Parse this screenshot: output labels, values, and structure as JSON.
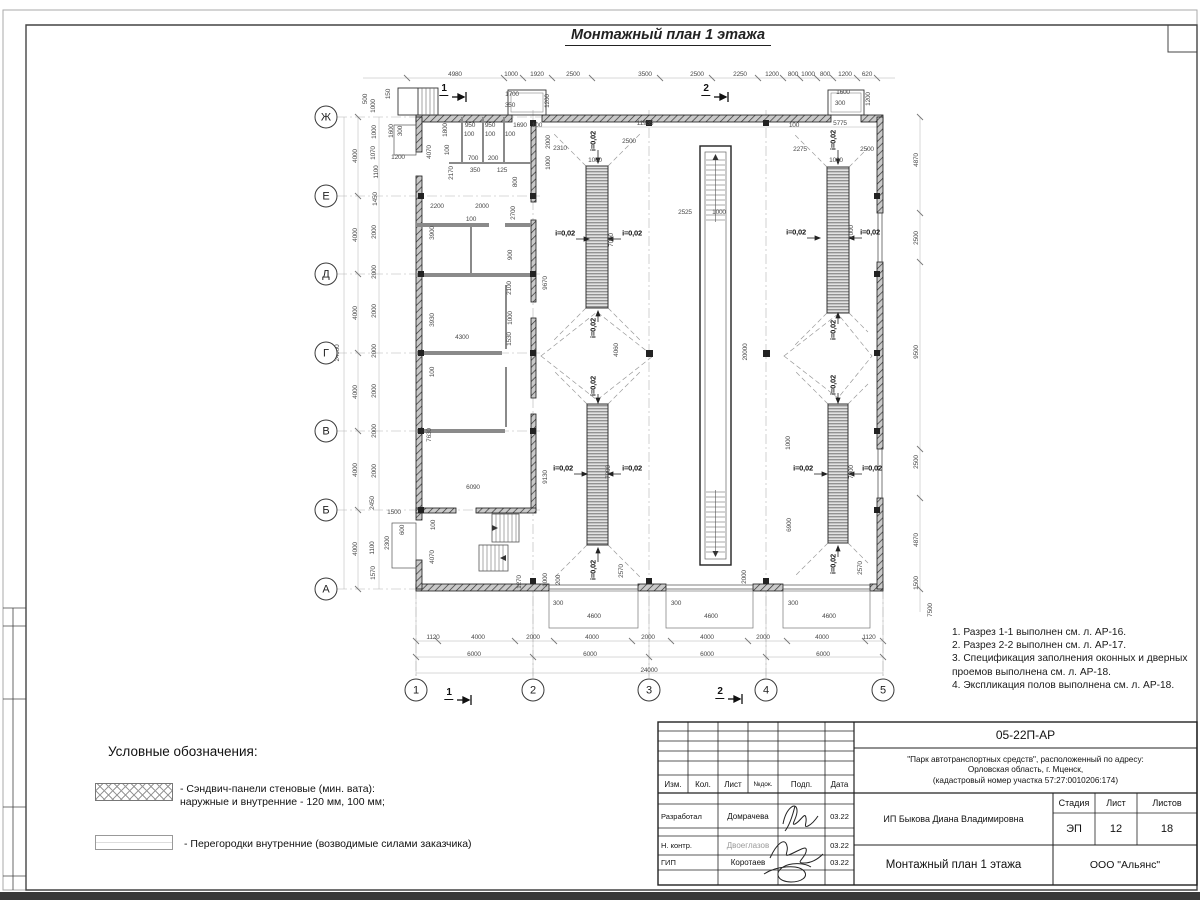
{
  "sheet": {
    "title": "Монтажный план 1 этажа"
  },
  "notes": {
    "items": [
      "1. Разрез 1-1 выполнен см. л. АР-16.",
      "2. Разрез 2-2 выполнен см. л. АР-17.",
      "3. Спецификация заполнения оконных и дверных\n    проемов выполнена см. л. АР-18.",
      "4. Экспликация полов выполнена см. л. АР-18."
    ]
  },
  "legend": {
    "title": "Условные обозначения:",
    "item1": "- Сэндвич-панели стеновые (мин. вата):\nнаружные и внутренние - 120 мм, 100 мм;",
    "item2": "- Перегородки внутренние (возводимые силами заказчика)"
  },
  "title_block": {
    "doc_number": "05-22П-АР",
    "project": "\"Парк автотранспортных средств\",  расположенный по адресу:\nОрловская область, г. Мценск,\n(кадастровый номер участка 57:27:0010206:174)",
    "client": "ИП Быкова Диана Владимировна",
    "sheet_title": "Монтажный план 1 этажа",
    "organization": "ООО \"Альянс\"",
    "stage_label": "Стадия",
    "stage": "ЭП",
    "sheet_label": "Лист",
    "sheet_no": "12",
    "sheets_label": "Листов",
    "sheets_total": "18",
    "col_izm": "Изм.",
    "col_kol": "Кол.",
    "col_list": "Лист",
    "col_ndok": "№док.",
    "col_podp": "Подп.",
    "col_data": "Дата",
    "rows": [
      {
        "role": "Разработал",
        "name": "Домрачева",
        "date": "03.22"
      },
      {
        "role": "Н. контр.",
        "name": "Двоеглазов",
        "date": "03.22"
      },
      {
        "role": "ГИП",
        "name": "Коротаев",
        "date": "03.22"
      }
    ]
  },
  "plan": {
    "axis_rows": [
      {
        "l": "Ж",
        "y": 117
      },
      {
        "l": "Е",
        "y": 196
      },
      {
        "l": "Д",
        "y": 274
      },
      {
        "l": "Г",
        "y": 353
      },
      {
        "l": "В",
        "y": 431
      },
      {
        "l": "Б",
        "y": 510
      },
      {
        "l": "А",
        "y": 589
      }
    ],
    "axis_cols": [
      {
        "l": "1",
        "x": 416
      },
      {
        "l": "2",
        "x": 533
      },
      {
        "l": "3",
        "x": 649
      },
      {
        "l": "4",
        "x": 766
      },
      {
        "l": "5",
        "x": 883
      }
    ],
    "labels": [
      [
        "4980",
        455,
        75
      ],
      [
        "1000",
        511,
        75
      ],
      [
        "1920",
        537,
        75
      ],
      [
        "2500",
        573,
        75
      ],
      [
        "3500",
        645,
        75
      ],
      [
        "2500",
        697,
        75
      ],
      [
        "2250",
        740,
        75
      ],
      [
        "1200",
        772,
        75
      ],
      [
        "800",
        793,
        75
      ],
      [
        "1000",
        808,
        75
      ],
      [
        "800",
        825,
        75
      ],
      [
        "1200",
        845,
        75
      ],
      [
        "620",
        867,
        75
      ],
      [
        "1700",
        512,
        95
      ],
      [
        "350",
        510,
        106
      ],
      [
        "1200",
        548,
        101,
        -90
      ],
      [
        "1600",
        843,
        93
      ],
      [
        "300",
        840,
        104
      ],
      [
        "1200",
        869,
        99,
        -90
      ],
      [
        "500",
        366,
        99,
        -90
      ],
      [
        "1000",
        374,
        106,
        -90
      ],
      [
        "150",
        389,
        94,
        -90
      ],
      [
        "1",
        444,
        90,
        0,
        "sec"
      ],
      [
        "2",
        706,
        90,
        0,
        "sec"
      ],
      [
        "1",
        449,
        694,
        0,
        "sec"
      ],
      [
        "2",
        720,
        693,
        0,
        "sec"
      ],
      [
        "100",
        537,
        126
      ],
      [
        "11935",
        645,
        124
      ],
      [
        "100",
        794,
        126
      ],
      [
        "5775",
        840,
        124
      ],
      [
        "1600",
        392,
        131,
        -90
      ],
      [
        "300",
        401,
        131,
        -90
      ],
      [
        "1200",
        398,
        158
      ],
      [
        "950",
        470,
        126
      ],
      [
        "950",
        490,
        126
      ],
      [
        "1690",
        520,
        126
      ],
      [
        "100",
        469,
        135
      ],
      [
        "100",
        490,
        135
      ],
      [
        "100",
        510,
        135
      ],
      [
        "1800",
        446,
        130,
        -90
      ],
      [
        "4070",
        430,
        152,
        -90
      ],
      [
        "100",
        448,
        150,
        -90
      ],
      [
        "2170",
        452,
        173,
        -90
      ],
      [
        "700",
        473,
        159
      ],
      [
        "200",
        493,
        159
      ],
      [
        "350",
        475,
        171
      ],
      [
        "125",
        502,
        171
      ],
      [
        "800",
        516,
        182,
        -90
      ],
      [
        "2200",
        437,
        207
      ],
      [
        "2000",
        482,
        207
      ],
      [
        "100",
        471,
        220
      ],
      [
        "3900",
        433,
        233,
        -90
      ],
      [
        "2700",
        514,
        213,
        -90
      ],
      [
        "900",
        511,
        255,
        -90
      ],
      [
        "2100",
        510,
        288,
        -90
      ],
      [
        "1000",
        511,
        318,
        -90
      ],
      [
        "4300",
        462,
        338
      ],
      [
        "1530",
        510,
        339,
        -90
      ],
      [
        "3930",
        433,
        320,
        -90
      ],
      [
        "9670",
        546,
        283,
        -90
      ],
      [
        "100",
        433,
        372,
        -90
      ],
      [
        "7630",
        430,
        435,
        -90
      ],
      [
        "6090",
        473,
        488
      ],
      [
        "9130",
        546,
        477,
        -90
      ],
      [
        "100",
        434,
        525,
        -90
      ],
      [
        "4070",
        433,
        557,
        -90
      ],
      [
        "1270",
        520,
        582,
        -90
      ],
      [
        "1000",
        546,
        580,
        -90
      ],
      [
        "200",
        559,
        580,
        -90
      ],
      [
        "1500",
        394,
        513
      ],
      [
        "600",
        403,
        530,
        -90
      ],
      [
        "2300",
        388,
        543,
        -90
      ],
      [
        "24000",
        338,
        353,
        -90
      ],
      [
        "4000",
        356,
        156,
        -90
      ],
      [
        "4000",
        356,
        235,
        -90
      ],
      [
        "4000",
        356,
        313,
        -90
      ],
      [
        "4000",
        356,
        392,
        -90
      ],
      [
        "4000",
        356,
        470,
        -90
      ],
      [
        "4000",
        356,
        549,
        -90
      ],
      [
        "1000",
        375,
        132,
        -90
      ],
      [
        "1070",
        374,
        153,
        -90
      ],
      [
        "1100",
        377,
        172,
        -90
      ],
      [
        "1450",
        376,
        199,
        -90
      ],
      [
        "2000",
        375,
        232,
        -90
      ],
      [
        "2000",
        375,
        272,
        -90
      ],
      [
        "2000",
        375,
        311,
        -90
      ],
      [
        "2000",
        375,
        351,
        -90
      ],
      [
        "2000",
        375,
        391,
        -90
      ],
      [
        "2000",
        375,
        431,
        -90
      ],
      [
        "2000",
        375,
        471,
        -90
      ],
      [
        "2450",
        373,
        503,
        -90
      ],
      [
        "1100",
        373,
        548,
        -90
      ],
      [
        "1570",
        374,
        573,
        -90
      ],
      [
        "2310",
        560,
        149
      ],
      [
        "2500",
        629,
        142
      ],
      [
        "1000",
        595,
        161
      ],
      [
        "2000",
        549,
        142,
        -90
      ],
      [
        "1000",
        549,
        163,
        -90
      ],
      [
        "2525",
        685,
        213
      ],
      [
        "1000",
        719,
        213
      ],
      [
        "7000",
        612,
        240,
        -90
      ],
      [
        "4060",
        617,
        350,
        -90
      ],
      [
        "20000",
        746,
        352,
        -90
      ],
      [
        "2570",
        622,
        571,
        -90
      ],
      [
        "2000",
        745,
        577,
        -90
      ],
      [
        "6900",
        790,
        525,
        -90
      ],
      [
        "1000",
        789,
        443,
        -90
      ],
      [
        "7000",
        609,
        472,
        -90
      ],
      [
        "2275",
        800,
        150
      ],
      [
        "2500",
        867,
        150
      ],
      [
        "1000",
        836,
        161
      ],
      [
        "7000",
        852,
        232,
        -90
      ],
      [
        "7000",
        852,
        472,
        -90
      ],
      [
        "2570",
        861,
        568,
        -90
      ],
      [
        "i=0,02",
        565,
        233,
        0,
        "slope"
      ],
      [
        "i=0,02",
        632,
        233,
        0,
        "slope"
      ],
      [
        "i=0,02",
        593,
        141,
        -90,
        "slope"
      ],
      [
        "i=0,02",
        593,
        328,
        -90,
        "slope"
      ],
      [
        "i=0,02",
        796,
        232,
        0,
        "slope"
      ],
      [
        "i=0,02",
        870,
        232,
        0,
        "slope"
      ],
      [
        "i=0,02",
        833,
        140,
        -90,
        "slope"
      ],
      [
        "i=0,02",
        833,
        330,
        -90,
        "slope"
      ],
      [
        "i=0,02",
        563,
        468,
        0,
        "slope"
      ],
      [
        "i=0,02",
        632,
        468,
        0,
        "slope"
      ],
      [
        "i=0,02",
        593,
        386,
        -90,
        "slope"
      ],
      [
        "i=0,02",
        593,
        570,
        -90,
        "slope"
      ],
      [
        "i=0,02",
        803,
        468,
        0,
        "slope"
      ],
      [
        "i=0,02",
        872,
        468,
        0,
        "slope"
      ],
      [
        "i=0,02",
        833,
        385,
        -90,
        "slope"
      ],
      [
        "i=0,02",
        833,
        564,
        -90,
        "slope"
      ],
      [
        "4870",
        917,
        160,
        -90
      ],
      [
        "2500",
        917,
        238,
        -90
      ],
      [
        "9500",
        917,
        352,
        -90
      ],
      [
        "2500",
        917,
        462,
        -90
      ],
      [
        "4870",
        917,
        540,
        -90
      ],
      [
        "1500",
        917,
        583,
        -90
      ],
      [
        "7500",
        931,
        610,
        -90
      ],
      [
        "300",
        558,
        604
      ],
      [
        "300",
        676,
        604
      ],
      [
        "300",
        793,
        604
      ],
      [
        "4600",
        594,
        617
      ],
      [
        "4600",
        711,
        617
      ],
      [
        "4600",
        829,
        617
      ],
      [
        "1120",
        433,
        638
      ],
      [
        "4000",
        478,
        638
      ],
      [
        "2000",
        533,
        638
      ],
      [
        "4000",
        592,
        638
      ],
      [
        "2000",
        648,
        638
      ],
      [
        "4000",
        707,
        638
      ],
      [
        "2000",
        763,
        638
      ],
      [
        "4000",
        822,
        638
      ],
      [
        "1120",
        869,
        638
      ],
      [
        "6000",
        474,
        655
      ],
      [
        "6000",
        590,
        655
      ],
      [
        "6000",
        707,
        655
      ],
      [
        "6000",
        823,
        655
      ],
      [
        "24000",
        649,
        671
      ]
    ]
  }
}
